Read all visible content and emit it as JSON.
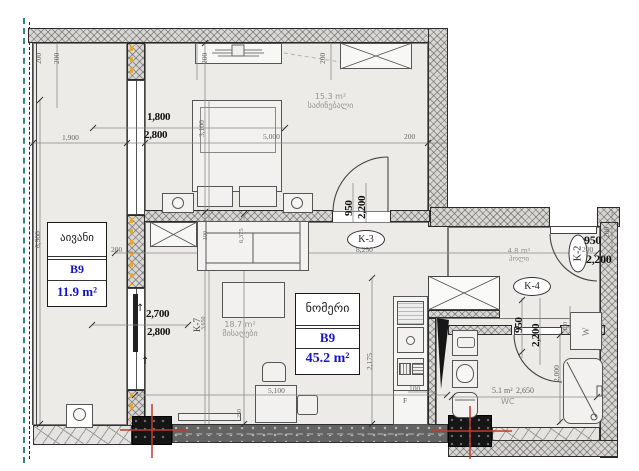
{
  "rooms": {
    "balcony": {
      "name": "აივანი",
      "unit": "B9",
      "area": "11.9 m²"
    },
    "bedroom": {
      "name": "საძინებალი",
      "area": "15.3 m²"
    },
    "living": {
      "name": "მისაღები",
      "area": "18.7 m²"
    },
    "suite": {
      "name": "ნომერი",
      "unit": "B9",
      "area": "45.2 m²"
    },
    "hall": {
      "name": "ჰოლი",
      "area": "4.8 m²"
    },
    "wc": {
      "name": "WC",
      "area": "5.1 m²"
    }
  },
  "doors": {
    "k2": "K-2",
    "k3": "K-3",
    "k4": "K-4",
    "k7": "K-7"
  },
  "appliances": {
    "washer": "W",
    "fridge": "F"
  },
  "symbols": {
    "up_arrow": "↑"
  },
  "dims": {
    "t200a": "200",
    "t200b": "200",
    "bed200l": "200",
    "bed200r": "200",
    "right200": "200",
    "wall200": "200",
    "edge200": "200",
    "k2_200": "200",
    "w1900": "1,900",
    "w1800": "1,800",
    "w2800t": "2,800",
    "w3100": "3,100",
    "w5000": "5,000",
    "k3_950": "950",
    "k3_2200": "2,200",
    "w8250": "8,250",
    "w6900": "6,900",
    "w2700": "2,700",
    "w2800b": "2,800",
    "w3650": "3,650",
    "w6375": "6,375",
    "bed100": "100",
    "w2175": "2,175",
    "w5100": "5,100",
    "w250": "250",
    "kit100": "100",
    "k2_950": "950",
    "k2_2200": "2,200",
    "k4_950": "950",
    "k4_2200": "2,200",
    "wc2650": "2,650",
    "sh2000": "2,000",
    "w100": "100"
  },
  "colors": {
    "accent_blue": "#1414c8",
    "column_red": "#c23b2e",
    "boundary_teal": "#2e8b7a"
  }
}
